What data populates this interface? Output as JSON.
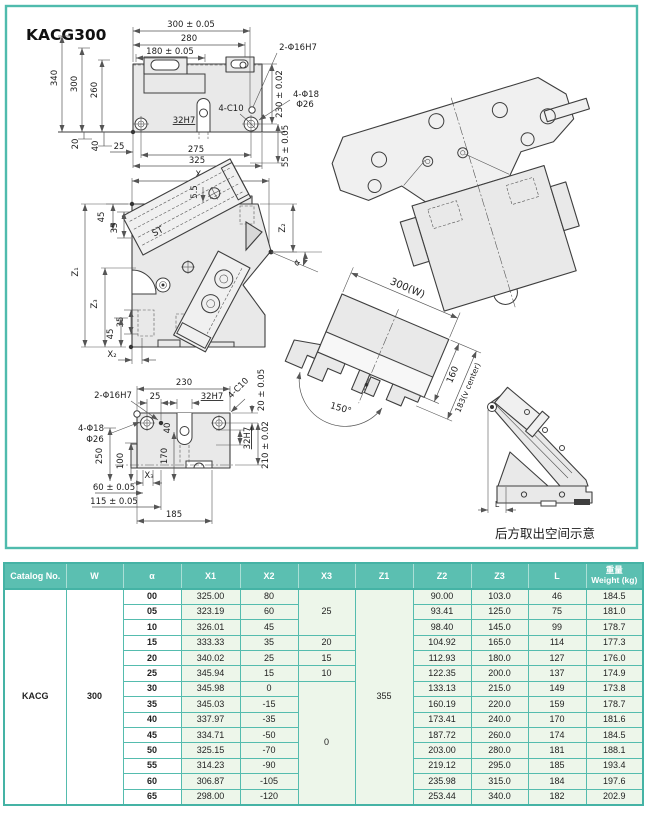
{
  "title": "KACG300",
  "views": {
    "top": {
      "d300": "300 ± 0.05",
      "d280": "280",
      "d180": "180 ± 0.05",
      "d340": "340",
      "d300v": "300",
      "d260": "260",
      "holes2": "2-Φ16H7",
      "d230": "230 ± 0.02",
      "holes4": "4-Φ18",
      "dia26": "Φ26",
      "c10": "4-C10",
      "key": "32H7",
      "d20": "20",
      "d40": "40",
      "d25": "25",
      "d275": "275",
      "d325": "325",
      "d55": "55 ± 0.05"
    },
    "front": {
      "x1": "X₁",
      "d55": "5.5",
      "d45t": "45",
      "d35t": "35",
      "z1": "Z₁",
      "z3": "Z₃",
      "d35b": "35",
      "d45b": "45",
      "x2": "X₂",
      "z2": "Z₂",
      "alpha": "α",
      "st": "ST"
    },
    "bottom": {
      "d230": "230",
      "holes2": "2-Φ16H7",
      "d25": "25",
      "keyt": "32H7",
      "c10": "4-C10",
      "d20": "20 ± 0.05",
      "holes4": "4-Φ18",
      "dia26": "Φ26",
      "d250": "250",
      "d100": "100",
      "d170": "170",
      "d40": "40",
      "x3": "X₃",
      "d60": "60 ± 0.05",
      "d115": "115 ± 0.05",
      "d185": "185",
      "keyr": "32H7",
      "d210": "210 ± 0.02"
    },
    "tilted": {
      "w": "300(W)",
      "d160": "160",
      "d183": "183(v center)",
      "d150": "150°"
    },
    "side": {
      "l": "L",
      "caption": "后方取出空间示意"
    }
  },
  "table": {
    "headers": {
      "catalog": "Catalog No.",
      "w": "W",
      "alpha": "α",
      "x1": "X1",
      "x2": "X2",
      "x3": "X3",
      "z1": "Z1",
      "z2": "Z2",
      "z3": "Z3",
      "l": "L",
      "weight_zh": "重量",
      "weight_en": "Weight (kg)"
    },
    "catalog": "KACG",
    "w": "300",
    "z1": "355",
    "rows": [
      {
        "alpha": "00",
        "x1": "325.00",
        "x2": "80",
        "x3": "25",
        "z2": "90.00",
        "z3": "103.0",
        "l": "46",
        "wt": "184.5"
      },
      {
        "alpha": "05",
        "x1": "323.19",
        "x2": "60",
        "z2": "93.41",
        "z3": "125.0",
        "l": "75",
        "wt": "181.0"
      },
      {
        "alpha": "10",
        "x1": "326.01",
        "x2": "45",
        "z2": "98.40",
        "z3": "145.0",
        "l": "99",
        "wt": "178.7"
      },
      {
        "alpha": "15",
        "x1": "333.33",
        "x2": "35",
        "x3": "20",
        "z2": "104.92",
        "z3": "165.0",
        "l": "114",
        "wt": "177.3"
      },
      {
        "alpha": "20",
        "x1": "340.02",
        "x2": "25",
        "x3": "15",
        "z2": "112.93",
        "z3": "180.0",
        "l": "127",
        "wt": "176.0"
      },
      {
        "alpha": "25",
        "x1": "345.94",
        "x2": "15",
        "x3": "10",
        "z2": "122.35",
        "z3": "200.0",
        "l": "137",
        "wt": "174.9"
      },
      {
        "alpha": "30",
        "x1": "345.98",
        "x2": "0",
        "x3": "0",
        "z2": "133.13",
        "z3": "215.0",
        "l": "149",
        "wt": "173.8"
      },
      {
        "alpha": "35",
        "x1": "345.03",
        "x2": "-15",
        "z2": "160.19",
        "z3": "220.0",
        "l": "159",
        "wt": "178.7"
      },
      {
        "alpha": "40",
        "x1": "337.97",
        "x2": "-35",
        "z2": "173.41",
        "z3": "240.0",
        "l": "170",
        "wt": "181.6"
      },
      {
        "alpha": "45",
        "x1": "334.71",
        "x2": "-50",
        "z2": "187.72",
        "z3": "260.0",
        "l": "174",
        "wt": "184.5"
      },
      {
        "alpha": "50",
        "x1": "325.15",
        "x2": "-70",
        "z2": "203.00",
        "z3": "280.0",
        "l": "181",
        "wt": "188.1"
      },
      {
        "alpha": "55",
        "x1": "314.23",
        "x2": "-90",
        "z2": "219.12",
        "z3": "295.0",
        "l": "185",
        "wt": "193.4"
      },
      {
        "alpha": "60",
        "x1": "306.87",
        "x2": "-105",
        "z2": "235.98",
        "z3": "315.0",
        "l": "184",
        "wt": "197.6"
      },
      {
        "alpha": "65",
        "x1": "298.00",
        "x2": "-120",
        "z2": "253.44",
        "z3": "340.0",
        "l": "182",
        "wt": "202.9"
      }
    ]
  }
}
